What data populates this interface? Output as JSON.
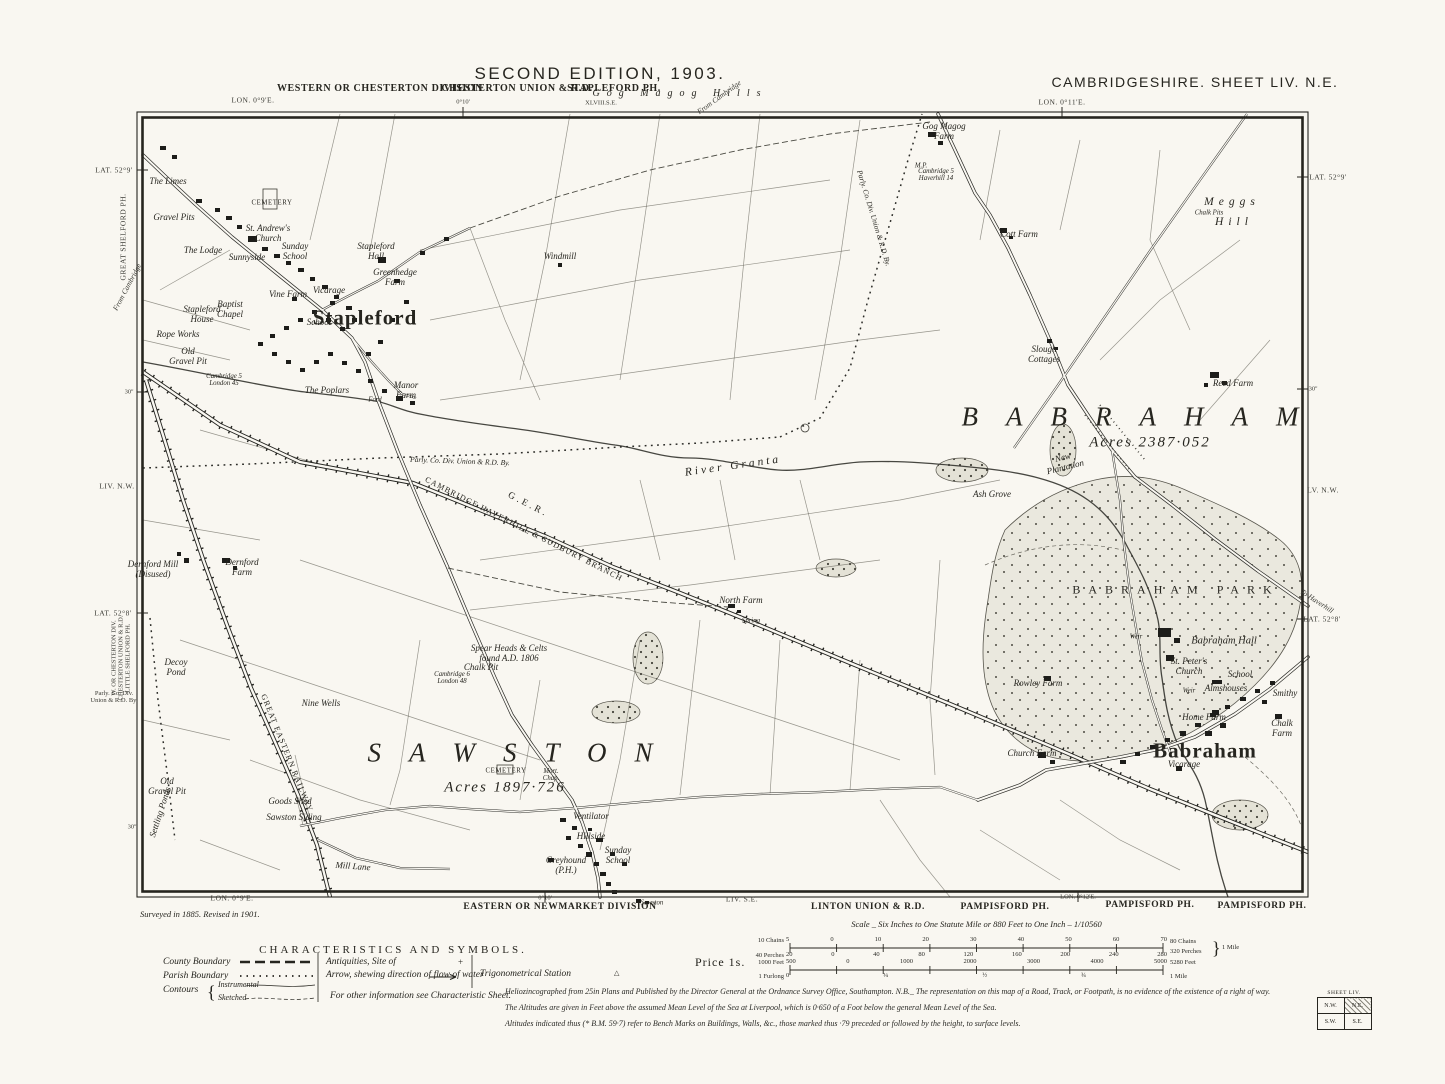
{
  "colors": {
    "paper": "#f9f7f1",
    "ink": "#26251f"
  },
  "header": {
    "edition": "SECOND EDITION, 1903.",
    "sheet": "CAMBRIDGESHIRE. SHEET LIV. N.E.",
    "division": "WESTERN OR CHESTERTON DIVISION",
    "union": "CHESTERTON UNION & R.D.",
    "parish": "STAPLEFORD PH.",
    "hills": "Gog Magog Hills",
    "adjoining": "XLVIII.S.E."
  },
  "price": "Price 1s.",
  "legend": {
    "title": "CHARACTERISTICS AND SYMBOLS.",
    "county": "County Boundary",
    "parish": "Parish Boundary",
    "contours": "Contours",
    "instrumental": "Instrumental",
    "sketched": "Sketched",
    "antiquities": "Antiquities, Site of",
    "antiquities_sym": "+",
    "arrow": "Arrow, shewing direction of flow of water",
    "trig": "Trigonometrical Station",
    "trig_sym": "△",
    "other": "For other information see Characteristic Sheet."
  },
  "scale": {
    "title": "Scale _ Six Inches to One Statute Mile or 880 Feet to One Inch – 1/10560",
    "chains_label": "10 Chains",
    "chains": [
      "5",
      "0",
      "10",
      "20",
      "30",
      "40",
      "50",
      "60",
      "70"
    ],
    "chains_right": "80 Chains",
    "perches_label": "40 Perches",
    "perches": [
      "20",
      "0",
      "40",
      "80",
      "120",
      "160",
      "200",
      "240",
      "280"
    ],
    "perches_right": "320 Perches",
    "mile_brace": "}",
    "mile": "1 Mile",
    "feet_label": "1000 Feet",
    "feet": [
      "500",
      "0",
      "1000",
      "2000",
      "3000",
      "4000",
      "5000"
    ],
    "feet_total": "5280 Feet",
    "furlong_label": "1 Furlong",
    "furlongs": [
      "0",
      "¼",
      "½",
      "¾"
    ],
    "furlong_right": "1 Mile"
  },
  "imprint": {
    "surveyed": "Surveyed in 1885.  Revised in 1901.",
    "line1": "Heliozincographed from 25in Plans and Published by the Director General at the Ordnance Survey Office, Southampton.   N.B._ The representation on this map of a Road, Track, or Footpath, is no evidence of the existence of a right of way.",
    "line2": "The Altitudes are given in Feet above the assumed Mean Level of the Sea at Liverpool, which is 0·650 of a Foot below the general Mean Level of the Sea.",
    "line3": "Altitudes indicated thus (* B.M. 59·7) refer to Bench Marks on Buildings, Walls, &c., those marked thus ·79 preceded or followed by the height, to surface levels."
  },
  "index": {
    "caption": "SHEET LIV.",
    "nw": "N.W.",
    "ne": "N.E.",
    "sw": "S.W.",
    "se": "S.E."
  },
  "map": {
    "labels": [
      {
        "t": "LON. 0°9'E.",
        "x": 253,
        "y": 100,
        "c": "margin"
      },
      {
        "t": "0°10'",
        "x": 463,
        "y": 102,
        "c": "mtiny"
      },
      {
        "t": "LON. 0°11'E.",
        "x": 1062,
        "y": 102,
        "c": "margin"
      },
      {
        "t": "From Cambridge",
        "x": 719,
        "y": 97,
        "c": "flow",
        "r": -36
      },
      {
        "t": "LAT. 52°9'",
        "x": 114,
        "y": 170,
        "c": "margin"
      },
      {
        "t": "GREAT SHELFORD PH.",
        "x": 123,
        "y": 237,
        "c": "margin",
        "r": -90
      },
      {
        "t": "From Cambridge",
        "x": 127,
        "y": 287,
        "c": "flow",
        "r": -62
      },
      {
        "t": "30''",
        "x": 129,
        "y": 392,
        "c": "mtiny"
      },
      {
        "t": "LIV. N.W.",
        "x": 117,
        "y": 486,
        "c": "margin"
      },
      {
        "t": "LAT. 52°8'",
        "x": 113,
        "y": 613,
        "c": "margin"
      },
      {
        "t": "W. OR CHESTERTON DIV.\nCHESTERTON UNION & R.D.\nLITTLE SHELFORD PH.",
        "x": 121,
        "y": 658,
        "c": "mtiny",
        "r": -90
      },
      {
        "t": "Parly. Co. Div.\nUnion & R.D. By.",
        "x": 114,
        "y": 697,
        "c": "mtiny"
      },
      {
        "t": "30''",
        "x": 132,
        "y": 827,
        "c": "mtiny"
      },
      {
        "t": "LAT. 52°9'",
        "x": 1328,
        "y": 177,
        "c": "margin"
      },
      {
        "t": "30''",
        "x": 1313,
        "y": 389,
        "c": "mtiny"
      },
      {
        "t": "LV. N.W.",
        "x": 1323,
        "y": 490,
        "c": "margin"
      },
      {
        "t": "To Haverhill",
        "x": 1317,
        "y": 601,
        "c": "flow",
        "r": 33
      },
      {
        "t": "LAT. 52°8'",
        "x": 1322,
        "y": 619,
        "c": "margin"
      },
      {
        "t": "LON. 0°9'E.",
        "x": 232,
        "y": 898,
        "c": "margin"
      },
      {
        "t": "0°10'",
        "x": 545,
        "y": 898,
        "c": "mtiny"
      },
      {
        "t": "EASTERN OR NEWMARKET DIVISION",
        "x": 560,
        "y": 907,
        "c": "division"
      },
      {
        "t": "Sawston",
        "x": 652,
        "y": 903,
        "c": "tiny"
      },
      {
        "t": "LIV. S.E.",
        "x": 742,
        "y": 899,
        "c": "margin"
      },
      {
        "t": "LINTON UNION & R.D.",
        "x": 868,
        "y": 907,
        "c": "division"
      },
      {
        "t": "PAMPISFORD PH.",
        "x": 1005,
        "y": 907,
        "c": "division"
      },
      {
        "t": "LON. 0°12'E.",
        "x": 1078,
        "y": 897,
        "c": "mtiny"
      },
      {
        "t": "PAMPISFORD PH.",
        "x": 1150,
        "y": 905,
        "c": "division"
      },
      {
        "t": "PAMPISFORD PH.",
        "x": 1262,
        "y": 906,
        "c": "division"
      },
      {
        "t": "XLVIII.S.E.",
        "x": 601,
        "y": 103,
        "c": "mtiny"
      },
      {
        "t": "Stapleford",
        "x": 365,
        "y": 318,
        "c": "village"
      },
      {
        "t": "SAWSTON",
        "x": 510,
        "y": 753,
        "c": "spread"
      },
      {
        "t": "BABRAHAM",
        "x": 1130,
        "y": 417,
        "c": "spread"
      },
      {
        "t": "Acres  1897·726",
        "x": 505,
        "y": 788,
        "c": "acres"
      },
      {
        "t": "Acres  2387·052",
        "x": 1150,
        "y": 443,
        "c": "acres"
      },
      {
        "t": "Babraham",
        "x": 1205,
        "y": 751,
        "c": "village"
      },
      {
        "t": "BABRAHAM  PARK",
        "x": 1172,
        "y": 590,
        "c": "park-n"
      },
      {
        "t": "Meggs",
        "x": 1229,
        "y": 202,
        "c": "hill"
      },
      {
        "t": "Chalk Pits",
        "x": 1209,
        "y": 213,
        "c": "tiny"
      },
      {
        "t": "Hill",
        "x": 1231,
        "y": 222,
        "c": "hill"
      },
      {
        "t": "River  Granta",
        "x": 733,
        "y": 466,
        "c": "river-n",
        "r": -8
      },
      {
        "t": "G.E.R.",
        "x": 528,
        "y": 505,
        "c": "railbig",
        "r": 27
      },
      {
        "t": "CAMBRIDGE HAVERHILL & SUDBURY BRANCH",
        "x": 524,
        "y": 529,
        "c": "railn",
        "r": 27
      },
      {
        "t": "GREAT EASTERN RAILWAY",
        "x": 287,
        "y": 753,
        "c": "railn",
        "r": 68
      },
      {
        "t": "Parly. Co. Div. Union & R.D. By.",
        "x": 460,
        "y": 461,
        "c": "bdyn",
        "r": 2
      },
      {
        "t": "Parly. Co. Div. Union & R.D. By.",
        "x": 874,
        "y": 218,
        "c": "bdyn",
        "r": 73
      },
      {
        "t": "The Limes",
        "x": 168,
        "y": 181
      },
      {
        "t": "Gravel Pits",
        "x": 174,
        "y": 217
      },
      {
        "t": "CEMETERY",
        "x": 272,
        "y": 203,
        "c": "caps"
      },
      {
        "t": "St. Andrew's\nChurch",
        "x": 268,
        "y": 233
      },
      {
        "t": "The Lodge",
        "x": 203,
        "y": 250
      },
      {
        "t": "Sunnyside",
        "x": 247,
        "y": 257
      },
      {
        "t": "Sunday\nSchool",
        "x": 295,
        "y": 251
      },
      {
        "t": "Stapleford\nHall",
        "x": 376,
        "y": 251
      },
      {
        "t": "Greenhedge\nFarm",
        "x": 395,
        "y": 277
      },
      {
        "t": "Windmill",
        "x": 560,
        "y": 256
      },
      {
        "t": "Vine Farm",
        "x": 288,
        "y": 294
      },
      {
        "t": "Vicarage",
        "x": 329,
        "y": 290
      },
      {
        "t": "Baptist\nChapel",
        "x": 230,
        "y": 309
      },
      {
        "t": "Stapleford\nHouse",
        "x": 202,
        "y": 314
      },
      {
        "t": "School",
        "x": 319,
        "y": 322
      },
      {
        "t": "Rope Works",
        "x": 178,
        "y": 334
      },
      {
        "t": "Old\nGravel Pit",
        "x": 188,
        "y": 356
      },
      {
        "t": "Cambridge 5\nLondon 45",
        "x": 224,
        "y": 380,
        "c": "tiny"
      },
      {
        "t": "The Poplars",
        "x": 327,
        "y": 390
      },
      {
        "t": "Manor\nFarm",
        "x": 406,
        "y": 390
      },
      {
        "t": "Ford",
        "x": 375,
        "y": 400,
        "c": "tiny"
      },
      {
        "t": "Gog Magog\nFarm",
        "x": 944,
        "y": 131
      },
      {
        "t": "M.P.",
        "x": 921,
        "y": 166,
        "c": "tiny"
      },
      {
        "t": "Cambridge 5\nHaverhill 14",
        "x": 936,
        "y": 175,
        "c": "tiny"
      },
      {
        "t": "Cott Farm",
        "x": 1019,
        "y": 234
      },
      {
        "t": "Slough\nCottages",
        "x": 1044,
        "y": 354
      },
      {
        "t": "Reed Farm",
        "x": 1233,
        "y": 383
      },
      {
        "t": "New\nPlantation",
        "x": 1064,
        "y": 462,
        "r": -14
      },
      {
        "t": "Ash Grove",
        "x": 992,
        "y": 494
      },
      {
        "t": "North Farm",
        "x": 741,
        "y": 600
      },
      {
        "t": "Spring",
        "x": 751,
        "y": 621,
        "c": "tiny"
      },
      {
        "t": "Dernford Mill\n(Disused)",
        "x": 153,
        "y": 569
      },
      {
        "t": "Dernford\nFarm",
        "x": 242,
        "y": 567
      },
      {
        "t": "Decoy\nPond",
        "x": 176,
        "y": 667
      },
      {
        "t": "Nine Wells",
        "x": 321,
        "y": 703
      },
      {
        "t": "Spear Heads & Celts\nfound A.D. 1806",
        "x": 509,
        "y": 653
      },
      {
        "t": "Chalk Pit",
        "x": 481,
        "y": 667
      },
      {
        "t": "Cambridge 6\nLondon 48",
        "x": 452,
        "y": 678,
        "c": "tiny"
      },
      {
        "t": "CEMETERY",
        "x": 506,
        "y": 771,
        "c": "caps"
      },
      {
        "t": "Mort.\nChap.",
        "x": 551,
        "y": 775,
        "c": "tiny"
      },
      {
        "t": "Goods Shed",
        "x": 290,
        "y": 801
      },
      {
        "t": "Sawston Siding",
        "x": 294,
        "y": 817
      },
      {
        "t": "Settling Ponds",
        "x": 160,
        "y": 812,
        "r": -72
      },
      {
        "t": "Old\nGravel Pit",
        "x": 167,
        "y": 786
      },
      {
        "t": "Mill Lane",
        "x": 353,
        "y": 866,
        "r": 4
      },
      {
        "t": "Ventilator",
        "x": 591,
        "y": 816
      },
      {
        "t": "Hillside",
        "x": 591,
        "y": 836
      },
      {
        "t": "Sunday\nSchool",
        "x": 618,
        "y": 855
      },
      {
        "t": "Greyhound\n(P.H.)",
        "x": 566,
        "y": 865
      },
      {
        "t": "Rowley Farm",
        "x": 1038,
        "y": 683
      },
      {
        "t": "Weir",
        "x": 1136,
        "y": 637,
        "c": "tiny"
      },
      {
        "t": "Babraham Hall",
        "x": 1224,
        "y": 641,
        "c": "feat10"
      },
      {
        "t": "St. Peter's\nChurch",
        "x": 1189,
        "y": 666
      },
      {
        "t": "School",
        "x": 1240,
        "y": 674
      },
      {
        "t": "Almshouses",
        "x": 1226,
        "y": 688
      },
      {
        "t": "Weir",
        "x": 1189,
        "y": 691,
        "c": "tiny"
      },
      {
        "t": "Smithy",
        "x": 1285,
        "y": 693
      },
      {
        "t": "Home Farm",
        "x": 1204,
        "y": 717
      },
      {
        "t": "Chalk\nFarm",
        "x": 1282,
        "y": 728
      },
      {
        "t": "Church Farm",
        "x": 1032,
        "y": 753
      },
      {
        "t": "Vicarage",
        "x": 1184,
        "y": 764
      }
    ],
    "buildings": [
      [
        160,
        146,
        6,
        4
      ],
      [
        172,
        155,
        5,
        4
      ],
      [
        196,
        199,
        6,
        4
      ],
      [
        215,
        208,
        5,
        4
      ],
      [
        226,
        216,
        6,
        4
      ],
      [
        237,
        225,
        5,
        4
      ],
      [
        248,
        236,
        9,
        6
      ],
      [
        262,
        247,
        6,
        4
      ],
      [
        274,
        254,
        6,
        4
      ],
      [
        286,
        261,
        5,
        4
      ],
      [
        298,
        268,
        6,
        4
      ],
      [
        310,
        277,
        5,
        4
      ],
      [
        322,
        285,
        6,
        4
      ],
      [
        334,
        295,
        5,
        4
      ],
      [
        346,
        306,
        6,
        4
      ],
      [
        352,
        318,
        5,
        4
      ],
      [
        340,
        327,
        5,
        4
      ],
      [
        326,
        318,
        5,
        4
      ],
      [
        312,
        310,
        5,
        4
      ],
      [
        298,
        318,
        5,
        4
      ],
      [
        284,
        326,
        5,
        4
      ],
      [
        270,
        334,
        5,
        4
      ],
      [
        258,
        342,
        5,
        4
      ],
      [
        272,
        352,
        5,
        4
      ],
      [
        286,
        360,
        5,
        4
      ],
      [
        300,
        368,
        5,
        4
      ],
      [
        314,
        360,
        5,
        4
      ],
      [
        328,
        352,
        5,
        4
      ],
      [
        342,
        361,
        5,
        4
      ],
      [
        356,
        369,
        5,
        4
      ],
      [
        368,
        379,
        5,
        4
      ],
      [
        382,
        389,
        5,
        4
      ],
      [
        396,
        396,
        7,
        5
      ],
      [
        410,
        401,
        5,
        4
      ],
      [
        366,
        352,
        5,
        4
      ],
      [
        378,
        340,
        5,
        4
      ],
      [
        390,
        318,
        5,
        4
      ],
      [
        404,
        300,
        5,
        4
      ],
      [
        378,
        257,
        8,
        6
      ],
      [
        394,
        279,
        6,
        4
      ],
      [
        420,
        251,
        5,
        4
      ],
      [
        444,
        237,
        5,
        4
      ],
      [
        292,
        297,
        5,
        4
      ],
      [
        330,
        301,
        5,
        4
      ],
      [
        558,
        263,
        4,
        4
      ],
      [
        928,
        132,
        8,
        5
      ],
      [
        938,
        141,
        5,
        4
      ],
      [
        1000,
        228,
        7,
        5
      ],
      [
        1009,
        236,
        4,
        3
      ],
      [
        1047,
        339,
        5,
        4
      ],
      [
        1054,
        347,
        4,
        3
      ],
      [
        1210,
        372,
        9,
        6
      ],
      [
        1222,
        381,
        5,
        4
      ],
      [
        1204,
        383,
        4,
        4
      ],
      [
        728,
        604,
        7,
        4
      ],
      [
        737,
        610,
        4,
        3
      ],
      [
        222,
        558,
        8,
        5
      ],
      [
        233,
        566,
        4,
        4
      ],
      [
        184,
        558,
        5,
        5
      ],
      [
        177,
        552,
        4,
        4
      ],
      [
        560,
        818,
        6,
        4
      ],
      [
        572,
        826,
        5,
        4
      ],
      [
        566,
        836,
        5,
        4
      ],
      [
        578,
        844,
        5,
        4
      ],
      [
        586,
        852,
        6,
        5
      ],
      [
        594,
        862,
        5,
        4
      ],
      [
        600,
        872,
        6,
        4
      ],
      [
        606,
        882,
        5,
        4
      ],
      [
        612,
        890,
        5,
        4
      ],
      [
        596,
        838,
        7,
        4
      ],
      [
        610,
        852,
        5,
        4
      ],
      [
        548,
        858,
        6,
        4
      ],
      [
        622,
        862,
        5,
        4
      ],
      [
        588,
        828,
        4,
        3
      ],
      [
        636,
        899,
        5,
        4
      ],
      [
        645,
        901,
        4,
        3
      ],
      [
        1158,
        628,
        13,
        9
      ],
      [
        1174,
        638,
        6,
        5
      ],
      [
        1166,
        655,
        8,
        6
      ],
      [
        1212,
        680,
        10,
        4
      ],
      [
        1044,
        676,
        7,
        5
      ],
      [
        1038,
        752,
        8,
        6
      ],
      [
        1050,
        760,
        5,
        4
      ],
      [
        1120,
        760,
        6,
        4
      ],
      [
        1135,
        752,
        5,
        4
      ],
      [
        1150,
        745,
        6,
        4
      ],
      [
        1165,
        738,
        5,
        4
      ],
      [
        1180,
        731,
        6,
        5
      ],
      [
        1195,
        723,
        6,
        4
      ],
      [
        1210,
        713,
        6,
        4
      ],
      [
        1225,
        705,
        5,
        4
      ],
      [
        1240,
        697,
        6,
        4
      ],
      [
        1255,
        689,
        5,
        4
      ],
      [
        1205,
        731,
        7,
        5
      ],
      [
        1220,
        723,
        6,
        5
      ],
      [
        1262,
        700,
        5,
        4
      ],
      [
        1270,
        681,
        5,
        4
      ],
      [
        1275,
        714,
        7,
        5
      ],
      [
        1212,
        710,
        7,
        5
      ],
      [
        1176,
        766,
        6,
        5
      ]
    ]
  }
}
